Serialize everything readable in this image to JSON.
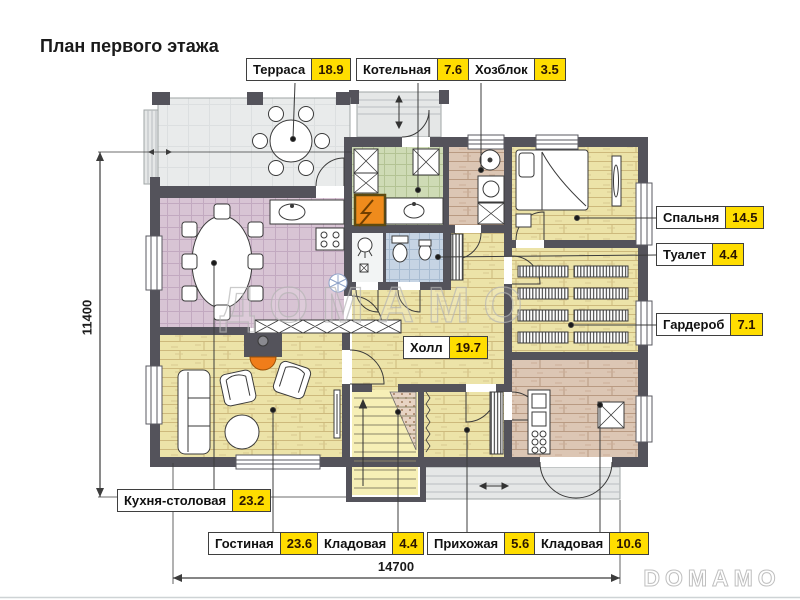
{
  "title": "План первого этажа",
  "rooms": [
    {
      "name": "Терраса",
      "area": "18.9"
    },
    {
      "name": "Котельная",
      "area": "7.6"
    },
    {
      "name": "Хозблок",
      "area": "3.5"
    },
    {
      "name": "Спальня",
      "area": "14.5"
    },
    {
      "name": "Туалет",
      "area": "4.4"
    },
    {
      "name": "Гардероб",
      "area": "7.1"
    },
    {
      "name": "Холл",
      "area": "19.7"
    },
    {
      "name": "Кухня-столовая",
      "area": "23.2"
    },
    {
      "name": "Гостиная",
      "area": "23.6"
    },
    {
      "name": "Кладовая",
      "area": "4.4"
    },
    {
      "name": "Прихожая",
      "area": "5.6"
    },
    {
      "name": "Кладовая",
      "area": "10.6"
    }
  ],
  "dimensions": {
    "height_mm": "11400",
    "width_mm": "14700"
  },
  "watermarks": {
    "center": "ДОМАМО",
    "corner": "DOMAMO"
  },
  "colors": {
    "wall": "#54535b",
    "label-yellow": "#ffdd00",
    "furnace-orange": "#ef8b1c",
    "floor-wood": "#ece3a8",
    "floor-wood-brown": "#dcc6b4",
    "floor-tile-mauve": "#d8c4d4",
    "floor-tile-green": "#cedbb5",
    "floor-tile-blue": "#c6d4e4",
    "floor-terrace": "#e9ebeb",
    "floor-stairs": "#f6efb6"
  }
}
